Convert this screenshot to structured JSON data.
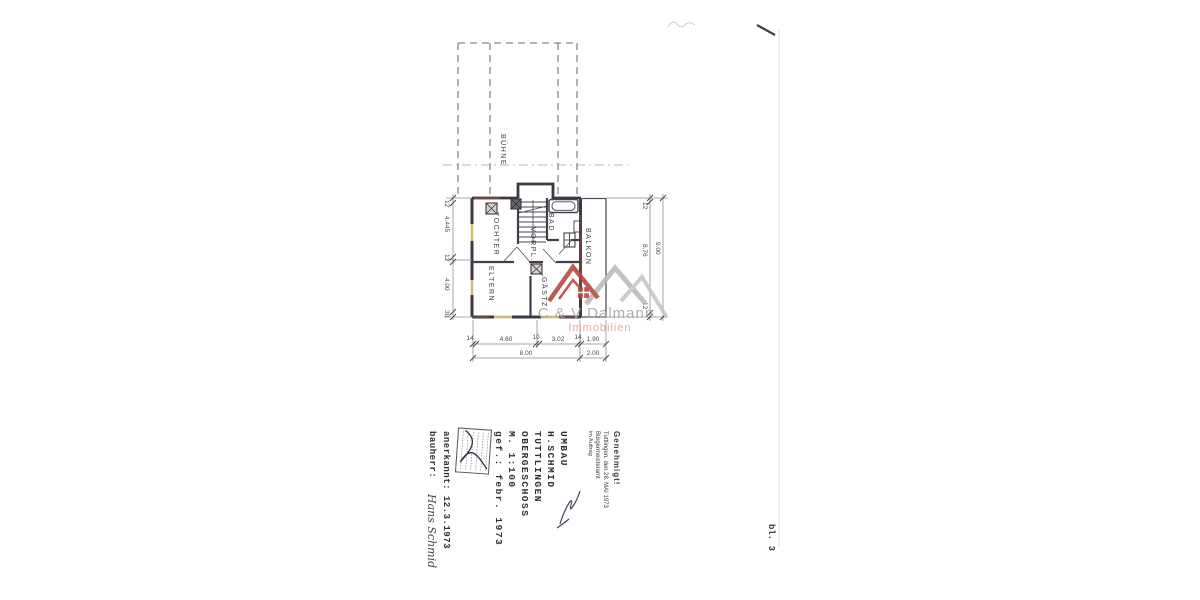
{
  "watermark": {
    "company": "C & V Dalmann",
    "subtitle": "Immobilien",
    "accent_red": "#b5463c",
    "accent_gray": "#bababa",
    "text_gray": "#a6a6a6",
    "text_salmon": "#e8a393"
  },
  "plan": {
    "room_labels": {
      "attic": "BÜHNE",
      "daughter": "TOCHTER",
      "bath": "BAD",
      "hall": "VORPL.",
      "balcony": "BALKON",
      "parents": "ELTERN",
      "guest": "GÄSTZ."
    },
    "dimensions": {
      "left": [
        "12",
        "4.445",
        "12",
        "4.00",
        "30"
      ],
      "right_segments": [
        "12",
        "8.76",
        "12"
      ],
      "right_total": "9.00",
      "bottom_segments": [
        "14",
        "4.60",
        "10",
        "3.02",
        "14",
        "1.90"
      ],
      "bottom_totals": [
        "8.00",
        "2.00"
      ]
    }
  },
  "title_block": {
    "project": "UMBAU",
    "client": "H.SCHMID",
    "city": "TUTTLINGEN",
    "floor": "OBERGESCHOSS",
    "scale": "M. 1:100",
    "drawn": "gef.: febr. 1973",
    "approved": "anerkannt: 12.3.1973",
    "owner_label": "bauherr:",
    "owner_signature": "Hans Schmid"
  },
  "approval_stamp": {
    "title": "Genehmigt!",
    "line2": "Tuttlingen, den 28. MAI 1973",
    "line3": "Bürgermeisteramt",
    "line4": "im Auftrag"
  },
  "sheet_label": "bl. 3"
}
